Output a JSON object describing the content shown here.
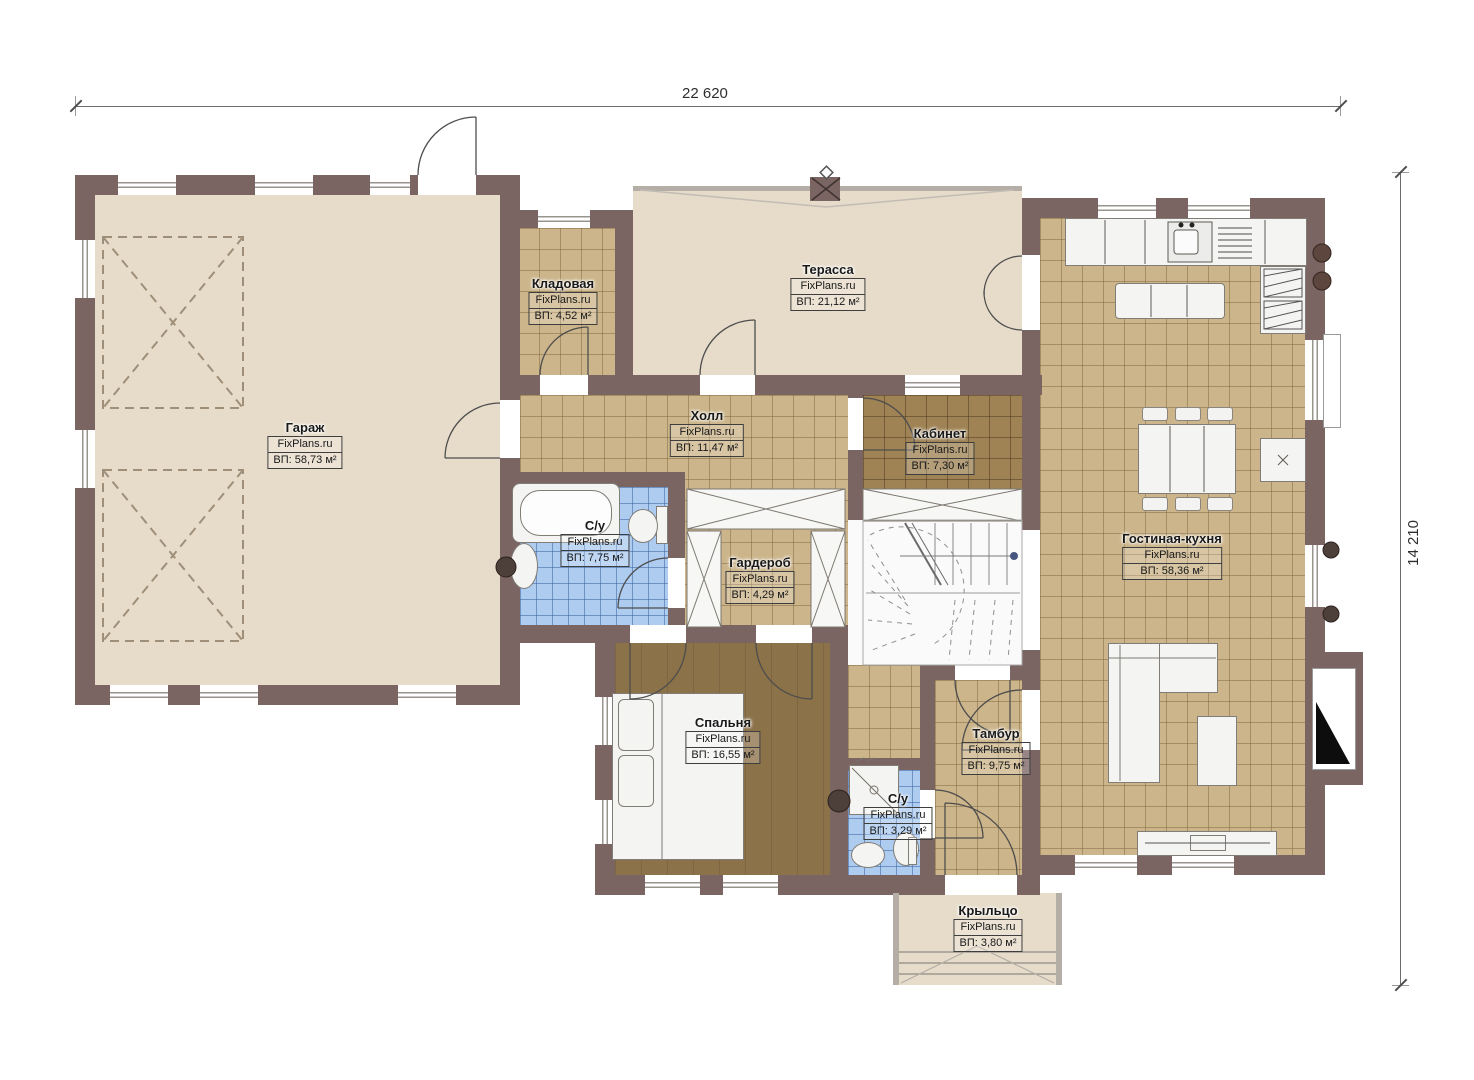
{
  "title": "План первого этажа",
  "brand": "FixPlans.ru",
  "dimensions": {
    "top": "22 620",
    "right": "14 210"
  },
  "rooms": [
    {
      "name": "Гараж",
      "brand": "FixPlans.ru",
      "area": "ВП: 58,73 м²"
    },
    {
      "name": "Кладовая",
      "brand": "FixPlans.ru",
      "area": "ВП: 4,52 м²"
    },
    {
      "name": "Терасса",
      "brand": "FixPlans.ru",
      "area": "ВП: 21,12 м²"
    },
    {
      "name": "Холл",
      "brand": "FixPlans.ru",
      "area": "ВП: 11,47 м²"
    },
    {
      "name": "Кабинет",
      "brand": "FixPlans.ru",
      "area": "ВП: 7,30 м²"
    },
    {
      "name": "Гостиная-кухня",
      "brand": "FixPlans.ru",
      "area": "ВП: 58,36 м²"
    },
    {
      "name": "С/у",
      "brand": "FixPlans.ru",
      "area": "ВП: 7,75 м²"
    },
    {
      "name": "Гардероб",
      "brand": "FixPlans.ru",
      "area": "ВП: 4,29 м²"
    },
    {
      "name": "Спальня",
      "brand": "FixPlans.ru",
      "area": "ВП: 16,55 м²"
    },
    {
      "name": "Тамбур",
      "brand": "FixPlans.ru",
      "area": "ВП: 9,75 м²"
    },
    {
      "name": "С/у",
      "brand": "FixPlans.ru",
      "area": "ВП: 3,29 м²"
    },
    {
      "name": "Крыльцо",
      "brand": "FixPlans.ru",
      "area": "ВП: 3,80 м²"
    }
  ],
  "colors": {
    "wall": "#7b6562",
    "floor_beige": "#e7dcca",
    "tile_tan": "#ccb58b",
    "tile_dark": "#9f8355",
    "tile_blue": "#adccf0",
    "bedroom": "#8c7249"
  }
}
